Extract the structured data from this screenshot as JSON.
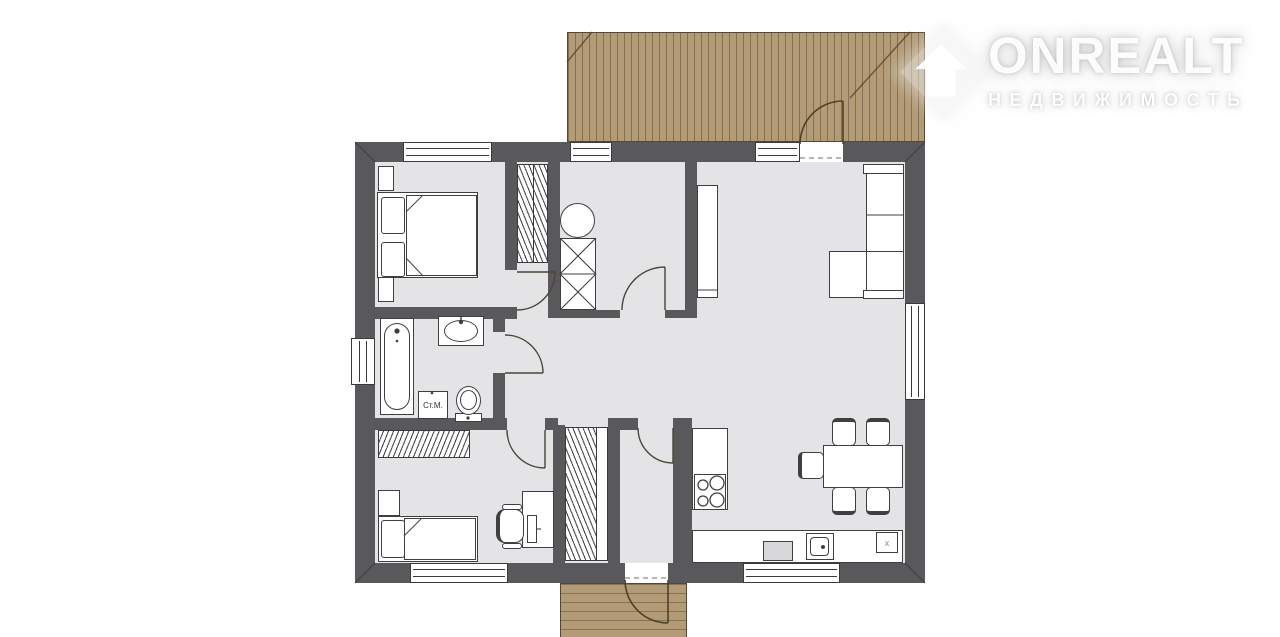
{
  "watermark": {
    "brand": "ONREALT",
    "subtitle": "НЕДВИЖИМОСТЬ",
    "icon": "house-diamond-icon"
  },
  "labels": {
    "washing_machine": "Ст.М.",
    "kitchen_corner_box": "x"
  },
  "colors": {
    "wall": "#59585b",
    "floor": "#e4e4e6",
    "deck": "#b39b77",
    "outline": "#3f3f42",
    "white": "#ffffff",
    "arc": "#4d4339",
    "arc_exterior": "#503f28"
  }
}
